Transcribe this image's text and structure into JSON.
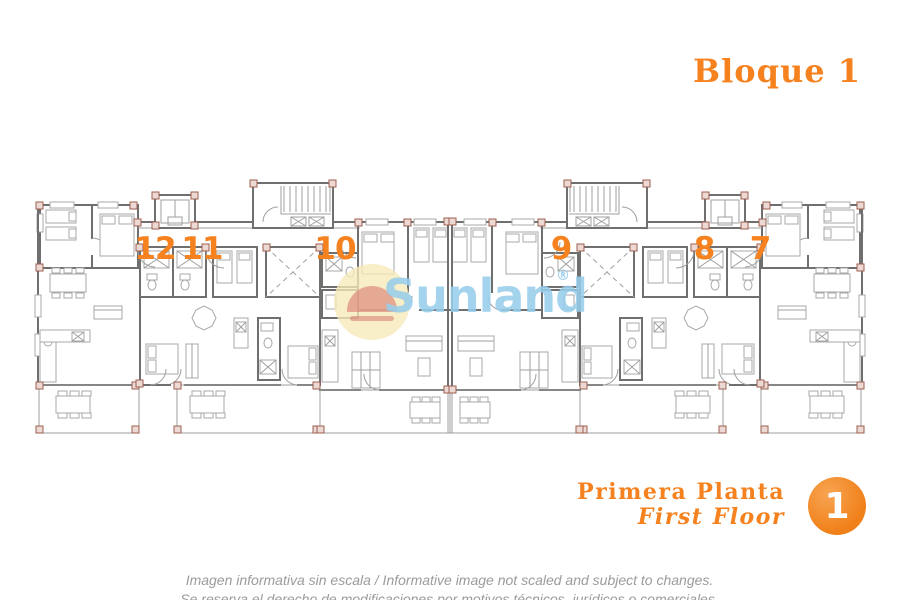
{
  "header": {
    "block_title": "Bloque 1"
  },
  "watermark": {
    "brand": "Sunland",
    "registered": "®"
  },
  "units": [
    "12",
    "11",
    "10",
    "9",
    "8",
    "7"
  ],
  "floor": {
    "title_es": "Primera Planta",
    "title_en": "First Floor",
    "badge_number": "1"
  },
  "disclaimer": {
    "line1": "Imagen informativa sin escala /  Informative image not scaled and subject to changes.",
    "line2": "Se reserva el derecho de modificaciones por motivos técnicos, jurídicos o comerciales."
  },
  "colors": {
    "accent_orange": "#f5821f",
    "watermark_blue": "#97cdeb",
    "plan_wall_gray": "#6f6f6f",
    "plan_light_gray": "#9f9f9f",
    "column_post_red": "#9c5f50",
    "disclaimer_gray": "#9b9b9b"
  }
}
